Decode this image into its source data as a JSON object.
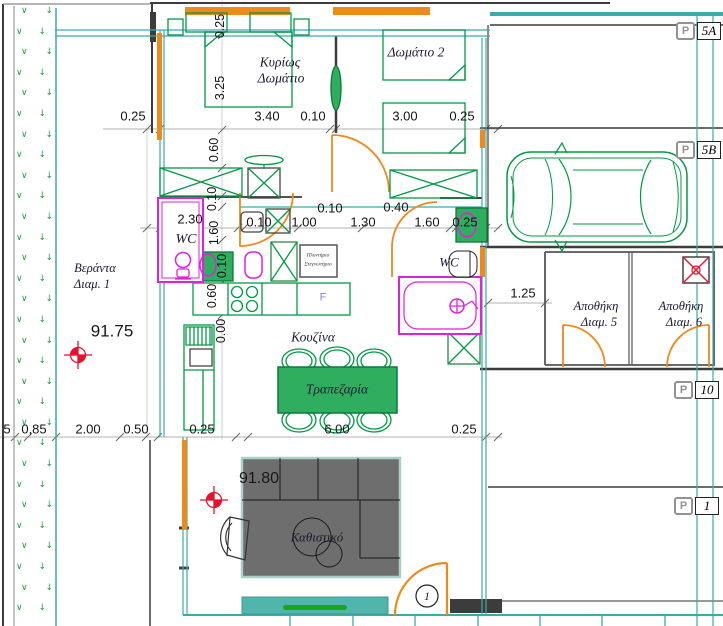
{
  "rooms": {
    "master_bedroom": {
      "line1": "Κυρίως",
      "line2": "Δωμάτιο"
    },
    "bedroom2": "Δωμάτιο 2",
    "wc1": "WC",
    "wc2": "WC",
    "kitchen": "Κουζίνα",
    "dining": "Τραπεζαρία",
    "living": "Καθιστικό",
    "veranda": {
      "line1": "Βεράντα",
      "line2": "Διαμ. 1"
    },
    "storage5": {
      "line1": "Αποθήκη",
      "line2": "Διαμ. 5"
    },
    "storage6": {
      "line1": "Αποθήκη",
      "line2": "Διαμ. 6"
    },
    "laundry": {
      "line1": "Πλυντήριο",
      "line2": "Στεγνωτήριο"
    },
    "fridge": "F"
  },
  "levels": {
    "veranda": "91.75",
    "living": "91.80"
  },
  "door_number": "1",
  "parking_symbol": "P",
  "parking": [
    {
      "id": "5A"
    },
    {
      "id": "5B"
    },
    {
      "id": "10"
    },
    {
      "id": "1"
    }
  ],
  "dims": {
    "top": [
      "0.25",
      "3.40",
      "0.10",
      "3.00",
      "0.25"
    ],
    "mid": [
      "2.30",
      "0.10",
      "1.00",
      "1.30",
      "1.60",
      "0.25"
    ],
    "mid_upper": [
      "0.10",
      "0.40"
    ],
    "bottom": [
      "5",
      "0,85",
      "2.00",
      "0.50",
      "0.25",
      "6.00",
      "0.25"
    ],
    "right": [
      "1.25"
    ],
    "vertical": [
      "0.25",
      "3.25",
      "0.60",
      "0.10",
      "1.60",
      "0.10",
      "0.60",
      "0.00"
    ]
  },
  "planter": {
    "glyphs": [
      "∨",
      "↓"
    ]
  },
  "colors": {
    "teal": "#3aabab",
    "green": "#009a44",
    "green_fill": "#2fae5f",
    "orange": "#ef8a1a",
    "magenta": "#dd22dd",
    "red": "#e8112d",
    "wall": "#3c3c3c",
    "sofa": "#6e6e6e",
    "rug": "#52b5ac"
  }
}
